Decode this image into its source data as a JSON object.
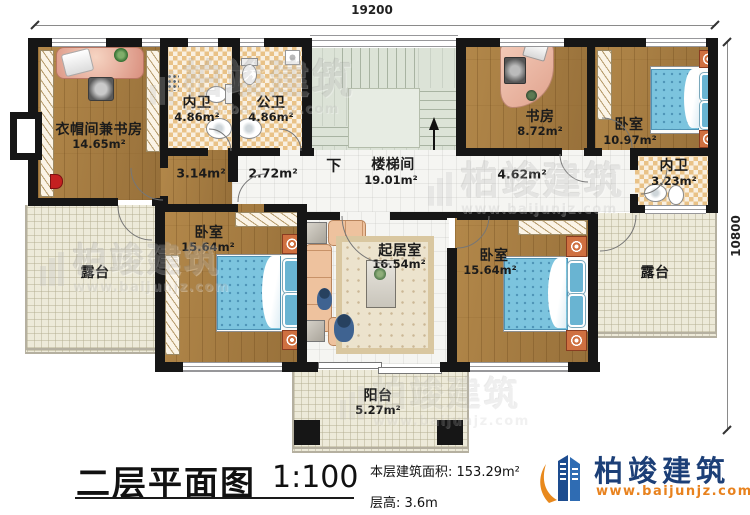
{
  "dimensions": {
    "width": "19200",
    "height": "10800"
  },
  "rooms": {
    "cloakroom": {
      "name": "衣帽间兼书房",
      "area": "14.65m²"
    },
    "inner_bath_1": {
      "name": "内卫",
      "area": "4.86m²"
    },
    "public_bath": {
      "name": "公卫",
      "area": "4.86m²"
    },
    "stairwell": {
      "name": "楼梯间",
      "area": "19.01m²",
      "down": "下"
    },
    "study": {
      "name": "书房",
      "area": "8.72m²"
    },
    "bedroom_top_right": {
      "name": "卧室",
      "area": "10.97m²"
    },
    "inner_bath_2": {
      "name": "内卫",
      "area": "3.23m²"
    },
    "bedroom_left": {
      "name": "卧室",
      "area": "15.64m²"
    },
    "living_room": {
      "name": "起居室",
      "area": "16.54m²"
    },
    "bedroom_right": {
      "name": "卧室",
      "area": "15.64m²"
    },
    "terrace_left": {
      "name": "露台"
    },
    "terrace_right": {
      "name": "露台"
    },
    "balcony": {
      "name": "阳台",
      "area": "5.27m²"
    },
    "hall_left": {
      "area": "3.14m²"
    },
    "hall_mid": {
      "area": "2.72m²"
    },
    "hall_right": {
      "area": "4.62m²"
    }
  },
  "footer": {
    "title": "二层平面图",
    "scale": "1:100",
    "area_label": "本层建筑面积: 153.29m²",
    "height_label": "层高: 3.6m"
  },
  "brand": {
    "name": "柏竣建筑",
    "url": "www.baijunjz.com"
  },
  "watermark": {
    "text": "柏竣建筑",
    "url": "www.baijunjz.com"
  },
  "colors": {
    "wall": "#161616",
    "wood": "#a87f44",
    "tile": "#e9c287",
    "terrace": "#edead9",
    "stair_floor": "#dce3d7",
    "bed": "#7cc4de",
    "sofa": "#eec29e",
    "brand_navy": "#1c3f77",
    "brand_orange": "#e8821e"
  }
}
